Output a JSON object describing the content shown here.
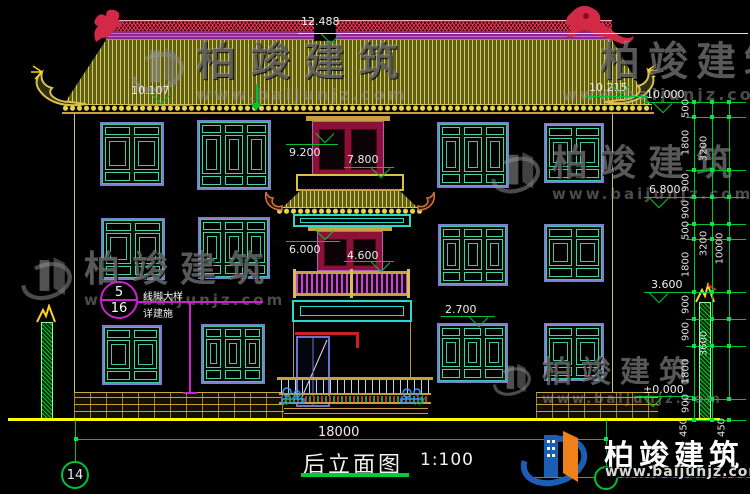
{
  "drawing": {
    "title": "后立面图",
    "scale": "1:100",
    "grid_bubble_left": "14",
    "overall_width": "18000"
  },
  "levels": {
    "ridge_top": "12.488",
    "left_eave": "10.107",
    "right_eave": "10.215",
    "right_10000": "10.000",
    "right_6800": "6.800",
    "right_3600": "3.600",
    "right_zero": "±0.000",
    "center_9200": "9.200",
    "center_7800": "7.800",
    "center_6000": "6.000",
    "center_4600": "4.600",
    "center_2700": "2.700"
  },
  "dims": {
    "inner": [
      "500",
      "1800",
      "900",
      "900",
      "500",
      "1800",
      "900",
      "900",
      "1800",
      "900"
    ],
    "mid": [
      "3200",
      "3200",
      "3600"
    ],
    "outer": "10000",
    "below_ground": [
      "450",
      "450"
    ]
  },
  "callout": {
    "detail_number": "5",
    "sheet_number": "16",
    "label_line1": "线脚大样",
    "label_line2": "详建施"
  },
  "watermark": {
    "brand": "柏竣建筑",
    "site": "www.baijunjz.com"
  },
  "colors": {
    "background": "#000000",
    "roof_tile": "#ddca4e",
    "window_teal": "#49d2a8",
    "window_purple": "#7e7ed2",
    "tower_crimson": "#8b1236",
    "railing_magenta": "#c846c8",
    "dimension_green": "#00c233",
    "ground_yellow": "#ffff00",
    "brick_tan": "#c8a83c",
    "logo_blue": "#1a5fb4",
    "logo_orange": "#f08018"
  }
}
